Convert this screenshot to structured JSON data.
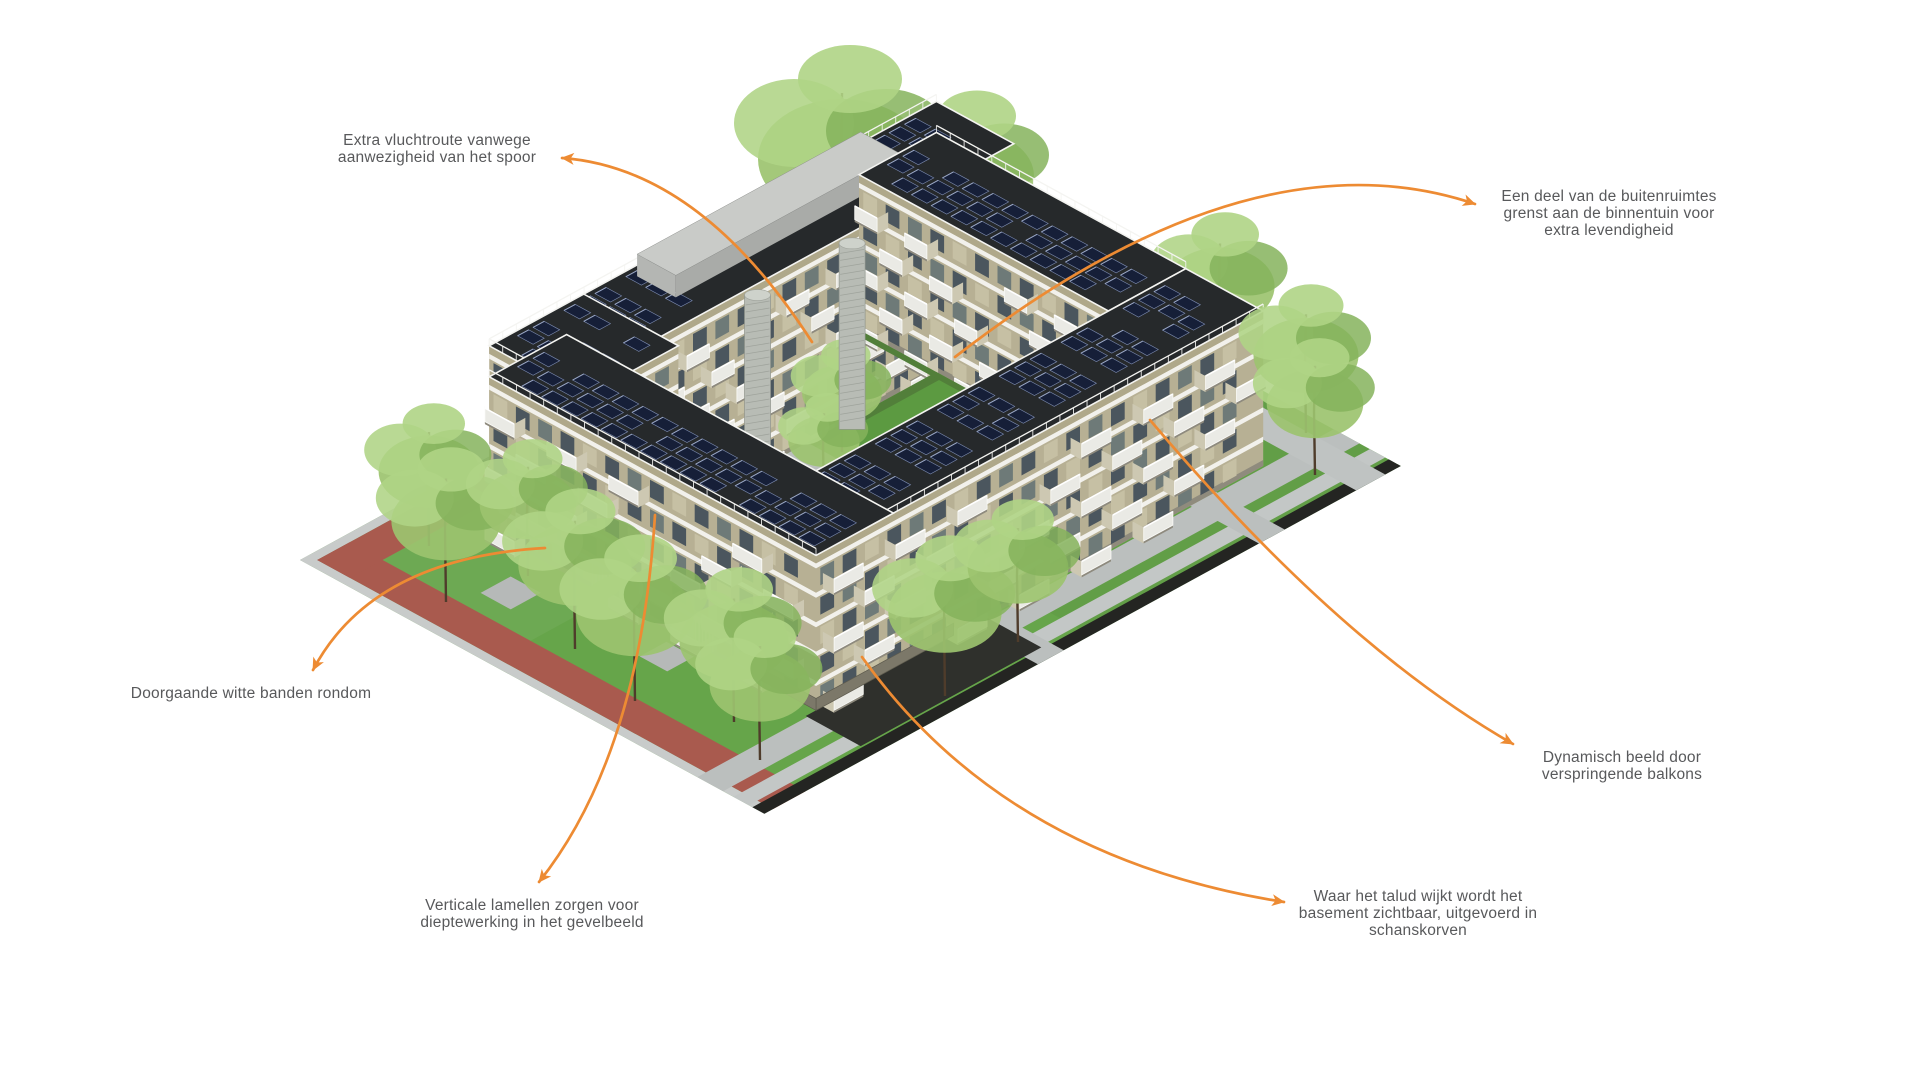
{
  "figure": {
    "description_role": "axonometric-building-diagram",
    "background": "#FFFFFF"
  },
  "colors": {
    "accent_orange": "#ED8B33",
    "label_text": "#58595B",
    "grass": "#66A54A",
    "grass_dark": "#5C9A41",
    "track_red": "#A95A4E",
    "curb_gray": "#C8CBCA",
    "path_gray": "#BBBFBE",
    "edge_black": "#242522",
    "talud_dark": "#2F302C",
    "roof_dark": "#26292B",
    "solar_panel": "#161F38",
    "solar_frame": "#7C8BB0",
    "facade_khaki": "#B7B094",
    "facade_panel": "#C6C0A4",
    "band_white": "#F2F1EC",
    "window_dark": "#4B565E",
    "window_mid": "#6E7A78",
    "balcony_face": "#EAEAE5",
    "balcony_side": "#CDC8B2",
    "plinth": "#8F8B7D",
    "parapet": "#AFA88A",
    "gabion": "#7C7869",
    "roofbox_top": "#C9CBC8",
    "roofbox_side": "#A9ABA8",
    "stair_tower": "#B8BCB5",
    "tree_light": "#AFD485",
    "tree_mid": "#9CC36F",
    "tree_dark": "#85B35C",
    "trunk": "#4F3C2B",
    "hedge": "#527F3A",
    "basin_rim": "#C3C6C5",
    "basin_wall": "#5F6A68",
    "water": "#93A19F",
    "gravel": "#A18764"
  },
  "annotations": [
    {
      "id": "vluchtroute",
      "lines": [
        "Extra vluchtroute vanwege",
        "aanwezigheid van het spoor"
      ],
      "x": 437,
      "y": 145,
      "align": "center",
      "arrow": {
        "tail": [
          812,
          342
        ],
        "control": [
          700,
          168
        ],
        "head": [
          562,
          158
        ]
      }
    },
    {
      "id": "buitenruimtes",
      "lines": [
        "Een deel van de buitenruimtes",
        "grenst aan de binnentuin voor",
        "extra levendigheid"
      ],
      "x": 1609,
      "y": 201,
      "align": "center",
      "arrow": {
        "tail": [
          955,
          357
        ],
        "control": [
          1250,
          128
        ],
        "head": [
          1475,
          204
        ]
      }
    },
    {
      "id": "witte-banden",
      "lines": [
        "Doorgaande witte banden rondom"
      ],
      "x": 251,
      "y": 698,
      "align": "center",
      "arrow": {
        "tail": [
          545,
          548
        ],
        "control": [
          372,
          558
        ],
        "head": [
          313,
          670
        ]
      }
    },
    {
      "id": "lamellen",
      "lines": [
        "Verticale lamellen zorgen voor",
        "dieptewerking in het gevelbeeld"
      ],
      "x": 532,
      "y": 910,
      "align": "center",
      "arrow": {
        "tail": [
          655,
          515
        ],
        "control": [
          640,
          755
        ],
        "head": [
          539,
          882
        ]
      }
    },
    {
      "id": "balkons",
      "lines": [
        "Dynamisch beeld door",
        "verspringende balkons"
      ],
      "x": 1622,
      "y": 762,
      "align": "center",
      "arrow": {
        "tail": [
          1150,
          420
        ],
        "control": [
          1340,
          645
        ],
        "head": [
          1513,
          744
        ]
      }
    },
    {
      "id": "talud",
      "lines": [
        "Waar het talud wijkt wordt het",
        "basement zichtbaar, uitgevoerd in",
        "schanskorven"
      ],
      "x": 1418,
      "y": 901,
      "align": "center",
      "arrow": {
        "tail": [
          862,
          657
        ],
        "control": [
          1005,
          858
        ],
        "head": [
          1284,
          902
        ]
      }
    }
  ]
}
